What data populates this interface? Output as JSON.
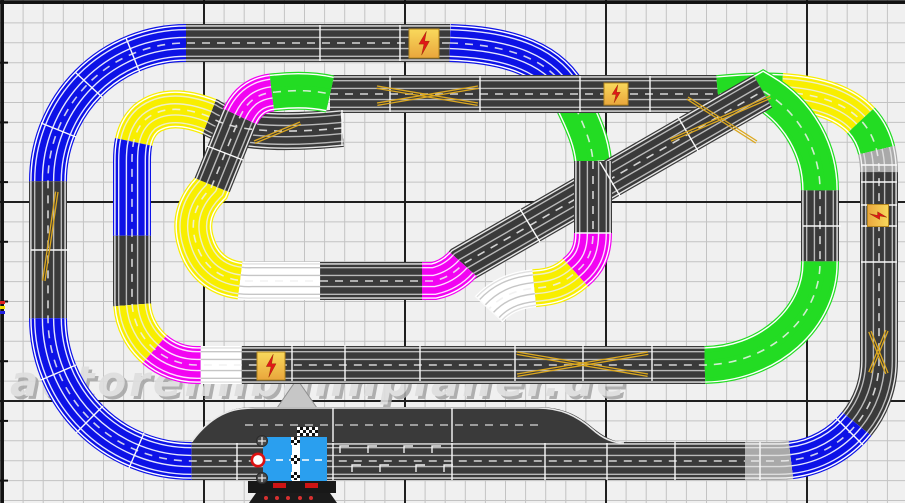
{
  "canvas": {
    "width": 905,
    "height": 503
  },
  "watermark": {
    "text": "autorennbahnplaner.de",
    "x": 10,
    "y": 396,
    "size": 42,
    "spacing": 3
  },
  "grid": {
    "bg": "#f0f0f0",
    "minor": "#c3c3c3",
    "major": "#1f1f1f",
    "origin": 3,
    "minor_dx": 20.1,
    "minor_dy": 19.9,
    "major_x": [
      3,
      204,
      405,
      606,
      807
    ],
    "major_y": [
      3,
      202,
      401
    ],
    "border": "#111111"
  },
  "palette": {
    "black": "#3a3a3a",
    "blue": "#0d12e6",
    "yellow": "#f8ee00",
    "green": "#23dc23",
    "magenta": "#f203f2",
    "white": "#ffffff",
    "gray": "#a9a9a9"
  },
  "line_styles": {
    "black": {
      "edge": "#e6e6e6",
      "rail": "#b9b9b9"
    },
    "blue": {
      "edge": "#ffffff",
      "rail": "#e4e6ff"
    },
    "yellow": {
      "edge": "#ffffff",
      "rail": "#eeeec8"
    },
    "green": {
      "edge": "#ffffff",
      "rail": "#défade"
    },
    "magenta": {
      "edge": "#ffffff",
      "rail": "#ffddff"
    },
    "white": {
      "edge": "#e0e0e0",
      "rail": "#c6c6c6"
    },
    "gray": {
      "edge": "#f2f2f2",
      "rail": "#dddddd"
    }
  },
  "centerline": {
    "color": "#f0f0f0",
    "dash": "8 7",
    "width": 1.6,
    "opacity": 0.85
  },
  "chains": [
    {
      "name": "outer-loop",
      "d": "M450,43 L186,43 A138,138 0 0 0 48,181 L48,318 A143,143 0 0 0 191,461 L745,461",
      "windows": [
        [
          0,
          264,
          "black"
        ],
        [
          264,
          481,
          "blue"
        ],
        [
          481,
          618,
          "black"
        ],
        [
          618,
          843,
          "blue"
        ],
        [
          843,
          20000,
          "black"
        ]
      ]
    },
    {
      "name": "top-dive-upper",
      "d": "M450,43 C510,45 553,60 571,98 C583,123 591,140 593,161",
      "windows": [
        [
          0,
          148,
          "blue"
        ],
        [
          148,
          20000,
          "green"
        ]
      ]
    },
    {
      "name": "row-b-right-loop",
      "d": "M330,94 L718,94 C800,86 876,94 879,168 L879,361 A100,100 0 0 1 779,461 L745,461",
      "windows": [
        [
          0,
          388,
          "black"
        ],
        [
          388,
          452,
          "green"
        ],
        [
          452,
          538,
          "yellow"
        ],
        [
          538,
          572,
          "green"
        ],
        [
          572,
          594,
          "gray"
        ],
        [
          594,
          851,
          "black"
        ],
        [
          851,
          928,
          "blue"
        ],
        [
          928,
          20000,
          "gray"
        ]
      ]
    },
    {
      "name": "inner-circuit",
      "d": "M342,128 C262,136 225,127 210,117 C182,106 161,107 146,119 C134,130 132,146 132,161 L132,300 A65,65 0 0 0 197,365 L700,365 A118,102 0 0 0 820,263 L820,192 A115,115 0 0 0 763,91 L463,264 A55,55 0 0 1 434,281 L252,281 C222,282 203,267 196,243 C189,221 196,203 211,188 L239,119 C247,100 259,93 276,92 C295,90 312,90 330,94",
      "windows": [
        [
          0,
          135,
          "black"
        ],
        [
          135,
          228,
          "yellow"
        ],
        [
          228,
          322,
          "blue"
        ],
        [
          322,
          391,
          "black"
        ],
        [
          391,
          442,
          "yellow"
        ],
        [
          442,
          492,
          "magenta"
        ],
        [
          492,
          533,
          "white"
        ],
        [
          533,
          996,
          "black"
        ],
        [
          996,
          1168,
          "green"
        ],
        [
          1168,
          1239,
          "black"
        ],
        [
          1239,
          1359,
          "green"
        ],
        [
          1359,
          1705,
          "black"
        ],
        [
          1705,
          1751,
          "magenta"
        ],
        [
          1751,
          1853,
          "black"
        ],
        [
          1853,
          1933,
          "white"
        ],
        [
          1933,
          2058,
          "yellow"
        ],
        [
          2058,
          2132,
          "black"
        ],
        [
          2132,
          2174,
          "magenta"
        ],
        [
          2174,
          20000,
          "green"
        ]
      ]
    },
    {
      "name": "connector-lower",
      "d": "M593,161 L593,233 C593,252 587,263 576,272 C563,284 550,287 536,288 C514,290 500,297 489,309",
      "windows": [
        [
          0,
          72,
          "black"
        ],
        [
          72,
          117,
          "magenta"
        ],
        [
          117,
          162,
          "yellow"
        ],
        [
          162,
          20000,
          "white"
        ]
      ]
    }
  ],
  "seams": {
    "color": "#fafafa",
    "width": 1.4,
    "lines": [
      [
        320,
        25,
        320,
        61
      ],
      [
        400,
        25,
        400,
        61
      ],
      [
        102,
        97,
        75,
        72
      ],
      [
        76,
        137,
        41,
        123
      ],
      [
        140,
        73,
        126,
        38
      ],
      [
        31,
        250,
        69,
        250
      ],
      [
        103,
        406,
        76,
        433
      ],
      [
        76,
        365,
        41,
        380
      ],
      [
        144,
        433,
        129,
        468
      ],
      [
        237,
        442,
        237,
        480
      ],
      [
        333,
        408,
        333,
        480
      ],
      [
        452,
        408,
        452,
        480
      ],
      [
        545,
        442,
        545,
        480
      ],
      [
        607,
        442,
        607,
        480
      ],
      [
        675,
        442,
        675,
        480
      ],
      [
        760,
        442,
        760,
        480
      ],
      [
        390,
        76,
        390,
        112
      ],
      [
        480,
        76,
        480,
        112
      ],
      [
        580,
        76,
        580,
        112
      ],
      [
        650,
        76,
        650,
        112
      ],
      [
        292,
        345,
        292,
        381
      ],
      [
        345,
        345,
        345,
        381
      ],
      [
        420,
        345,
        420,
        381
      ],
      [
        515,
        345,
        515,
        381
      ],
      [
        583,
        345,
        583,
        381
      ],
      [
        652,
        345,
        652,
        381
      ],
      [
        861,
        165,
        897,
        165
      ],
      [
        861,
        182,
        897,
        182
      ],
      [
        861,
        205,
        897,
        205
      ],
      [
        861,
        226,
        897,
        226
      ],
      [
        861,
        262,
        897,
        262
      ],
      [
        803,
        226,
        841,
        226
      ],
      [
        520,
        209,
        540,
        242
      ],
      [
        600,
        162,
        620,
        196
      ],
      [
        678,
        117,
        698,
        151
      ],
      [
        207,
        146,
        243,
        160
      ],
      [
        575,
        233,
        611,
        233
      ],
      [
        342,
        110,
        342,
        146
      ],
      [
        475,
        296,
        503,
        322
      ],
      [
        836,
        418,
        863,
        445
      ]
    ]
  },
  "cross_marks": {
    "color": "#dca81f",
    "width": 1.3,
    "twin_offset": 2.4,
    "lines": [
      [
        377,
        86,
        478,
        103
      ],
      [
        377,
        103,
        478,
        86
      ],
      [
        517,
        352,
        648,
        374
      ],
      [
        517,
        374,
        648,
        352
      ],
      [
        670,
        139,
        770,
        96
      ],
      [
        688,
        97,
        757,
        141
      ],
      [
        58,
        192,
        45,
        281
      ],
      [
        871,
        331,
        888,
        373
      ],
      [
        888,
        331,
        871,
        373
      ],
      [
        254,
        141,
        300,
        122
      ]
    ]
  },
  "lightning_icons": [
    {
      "x": 409,
      "y": 29,
      "w": 30,
      "h": 29,
      "rot": 0
    },
    {
      "x": 604,
      "y": 83,
      "w": 24,
      "h": 22,
      "rot": 0
    },
    {
      "x": 257,
      "y": 352,
      "w": 28,
      "h": 28,
      "rot": 0
    },
    {
      "x": 867,
      "y": 205,
      "w": 22,
      "h": 21,
      "rot": 90
    }
  ],
  "icon_style": {
    "fill1": "#f9d95c",
    "fill2": "#e9a63c",
    "border": "#b4861e",
    "bolt": "#e01818"
  },
  "pit_widening": {
    "fill": "#3a3a3a",
    "shape": "M192,443 C215,410 235,407 258,407 L538,407 C562,407 578,415 593,428 C603,436 613,442 625,443 L192,443 Z",
    "guide": "M192,441 C216,410 236,408 258,408 L538,408 C561,408 577,416 592,429 C602,438 612,443 624,443",
    "guide_color": "#e8e8e8",
    "dash_line": "M245,425 L545,425"
  },
  "brackets": {
    "color": "#f0f0f0",
    "width": 1.4,
    "positions": [
      [
        340,
        446
      ],
      [
        368,
        446
      ],
      [
        404,
        446
      ],
      [
        432,
        446
      ],
      [
        352,
        465
      ],
      [
        380,
        465
      ],
      [
        416,
        465
      ],
      [
        444,
        465
      ]
    ]
  },
  "control_unit": {
    "box": [
      263,
      437,
      64,
      44
    ],
    "box_color": "#2a9fef",
    "stripe_x": 292,
    "stripe_w": 8,
    "stripe_color": "#ffffff",
    "dash_y": 460,
    "circle": [
      258,
      460,
      6.2
    ],
    "circle_ring": "#dd1111",
    "gears": [
      [
        262,
        441
      ],
      [
        262,
        478
      ]
    ],
    "gear_color": "#4a4a4a",
    "checker_cells": [
      [
        291,
        437,
        9,
        8
      ],
      [
        291,
        455,
        9,
        9
      ],
      [
        291,
        472,
        9,
        8
      ]
    ],
    "finish_strip": [
      297,
      427,
      21,
      9
    ],
    "base": [
      248,
      481,
      88,
      12
    ],
    "base_color": "#181818",
    "labels": [
      [
        273,
        483,
        13,
        5
      ],
      [
        305,
        483,
        13,
        5
      ]
    ],
    "label_color": "#cc1414",
    "pedestal": "M256,493 L330,493 L337,503 L249,503 Z",
    "pedestal_color": "#1b1b1b",
    "dots_y": 498,
    "dots_x": [
      266,
      277,
      288,
      300,
      311
    ],
    "dot_color": "#d83030"
  },
  "direction_arrow": {
    "shape": "M297,379 L317,408 L306,408 L306,428 L288,428 L288,408 L277,408 Z",
    "fill": "#c6c6c6",
    "stroke": "#8f8f8f"
  },
  "border_ticks": [
    {
      "x": 0,
      "y": 301,
      "w": 5,
      "h": 3,
      "c": "#e02020"
    },
    {
      "x": 0,
      "y": 306,
      "w": 5,
      "h": 3,
      "c": "#f0e000"
    },
    {
      "x": 0,
      "y": 311,
      "w": 5,
      "h": 3,
      "c": "#2020e0"
    }
  ]
}
